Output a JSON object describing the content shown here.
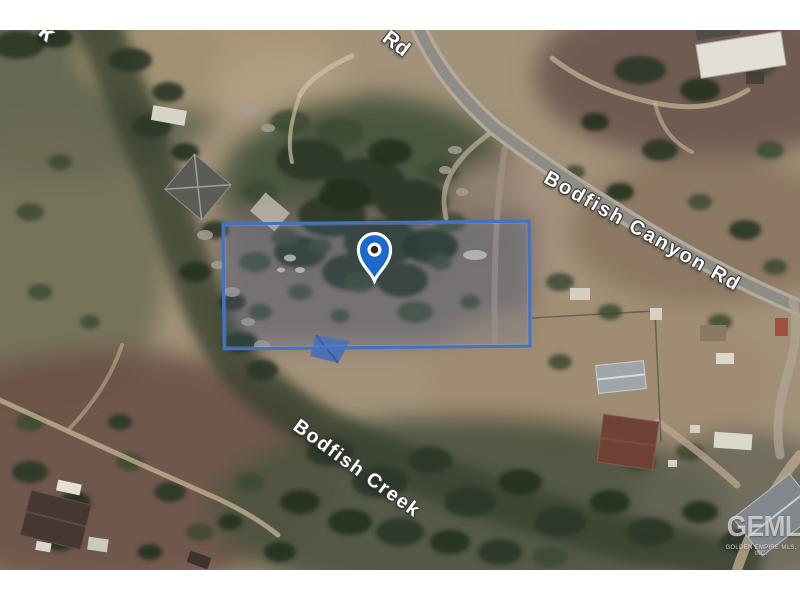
{
  "window": {
    "width": 800,
    "height": 600,
    "background": "#ffffff"
  },
  "map": {
    "kind": "satellite-imagery",
    "labels": {
      "road_fragment_top": "Rd",
      "creek_fragment_top_left": "k",
      "road_main": "Bodfish Canyon Rd",
      "creek_main": "Bodfish Creek"
    },
    "marker": {
      "color": "#1c69cc",
      "ring": "#ffffff",
      "dot": "#2e2620"
    },
    "boundary": {
      "stroke": "#4273c4",
      "fill": "rgba(96,130,190,0.16)"
    },
    "watermark": {
      "logo": "GEMLS",
      "tagline": "GOLDEN EMPIRE MLS, INC."
    }
  }
}
